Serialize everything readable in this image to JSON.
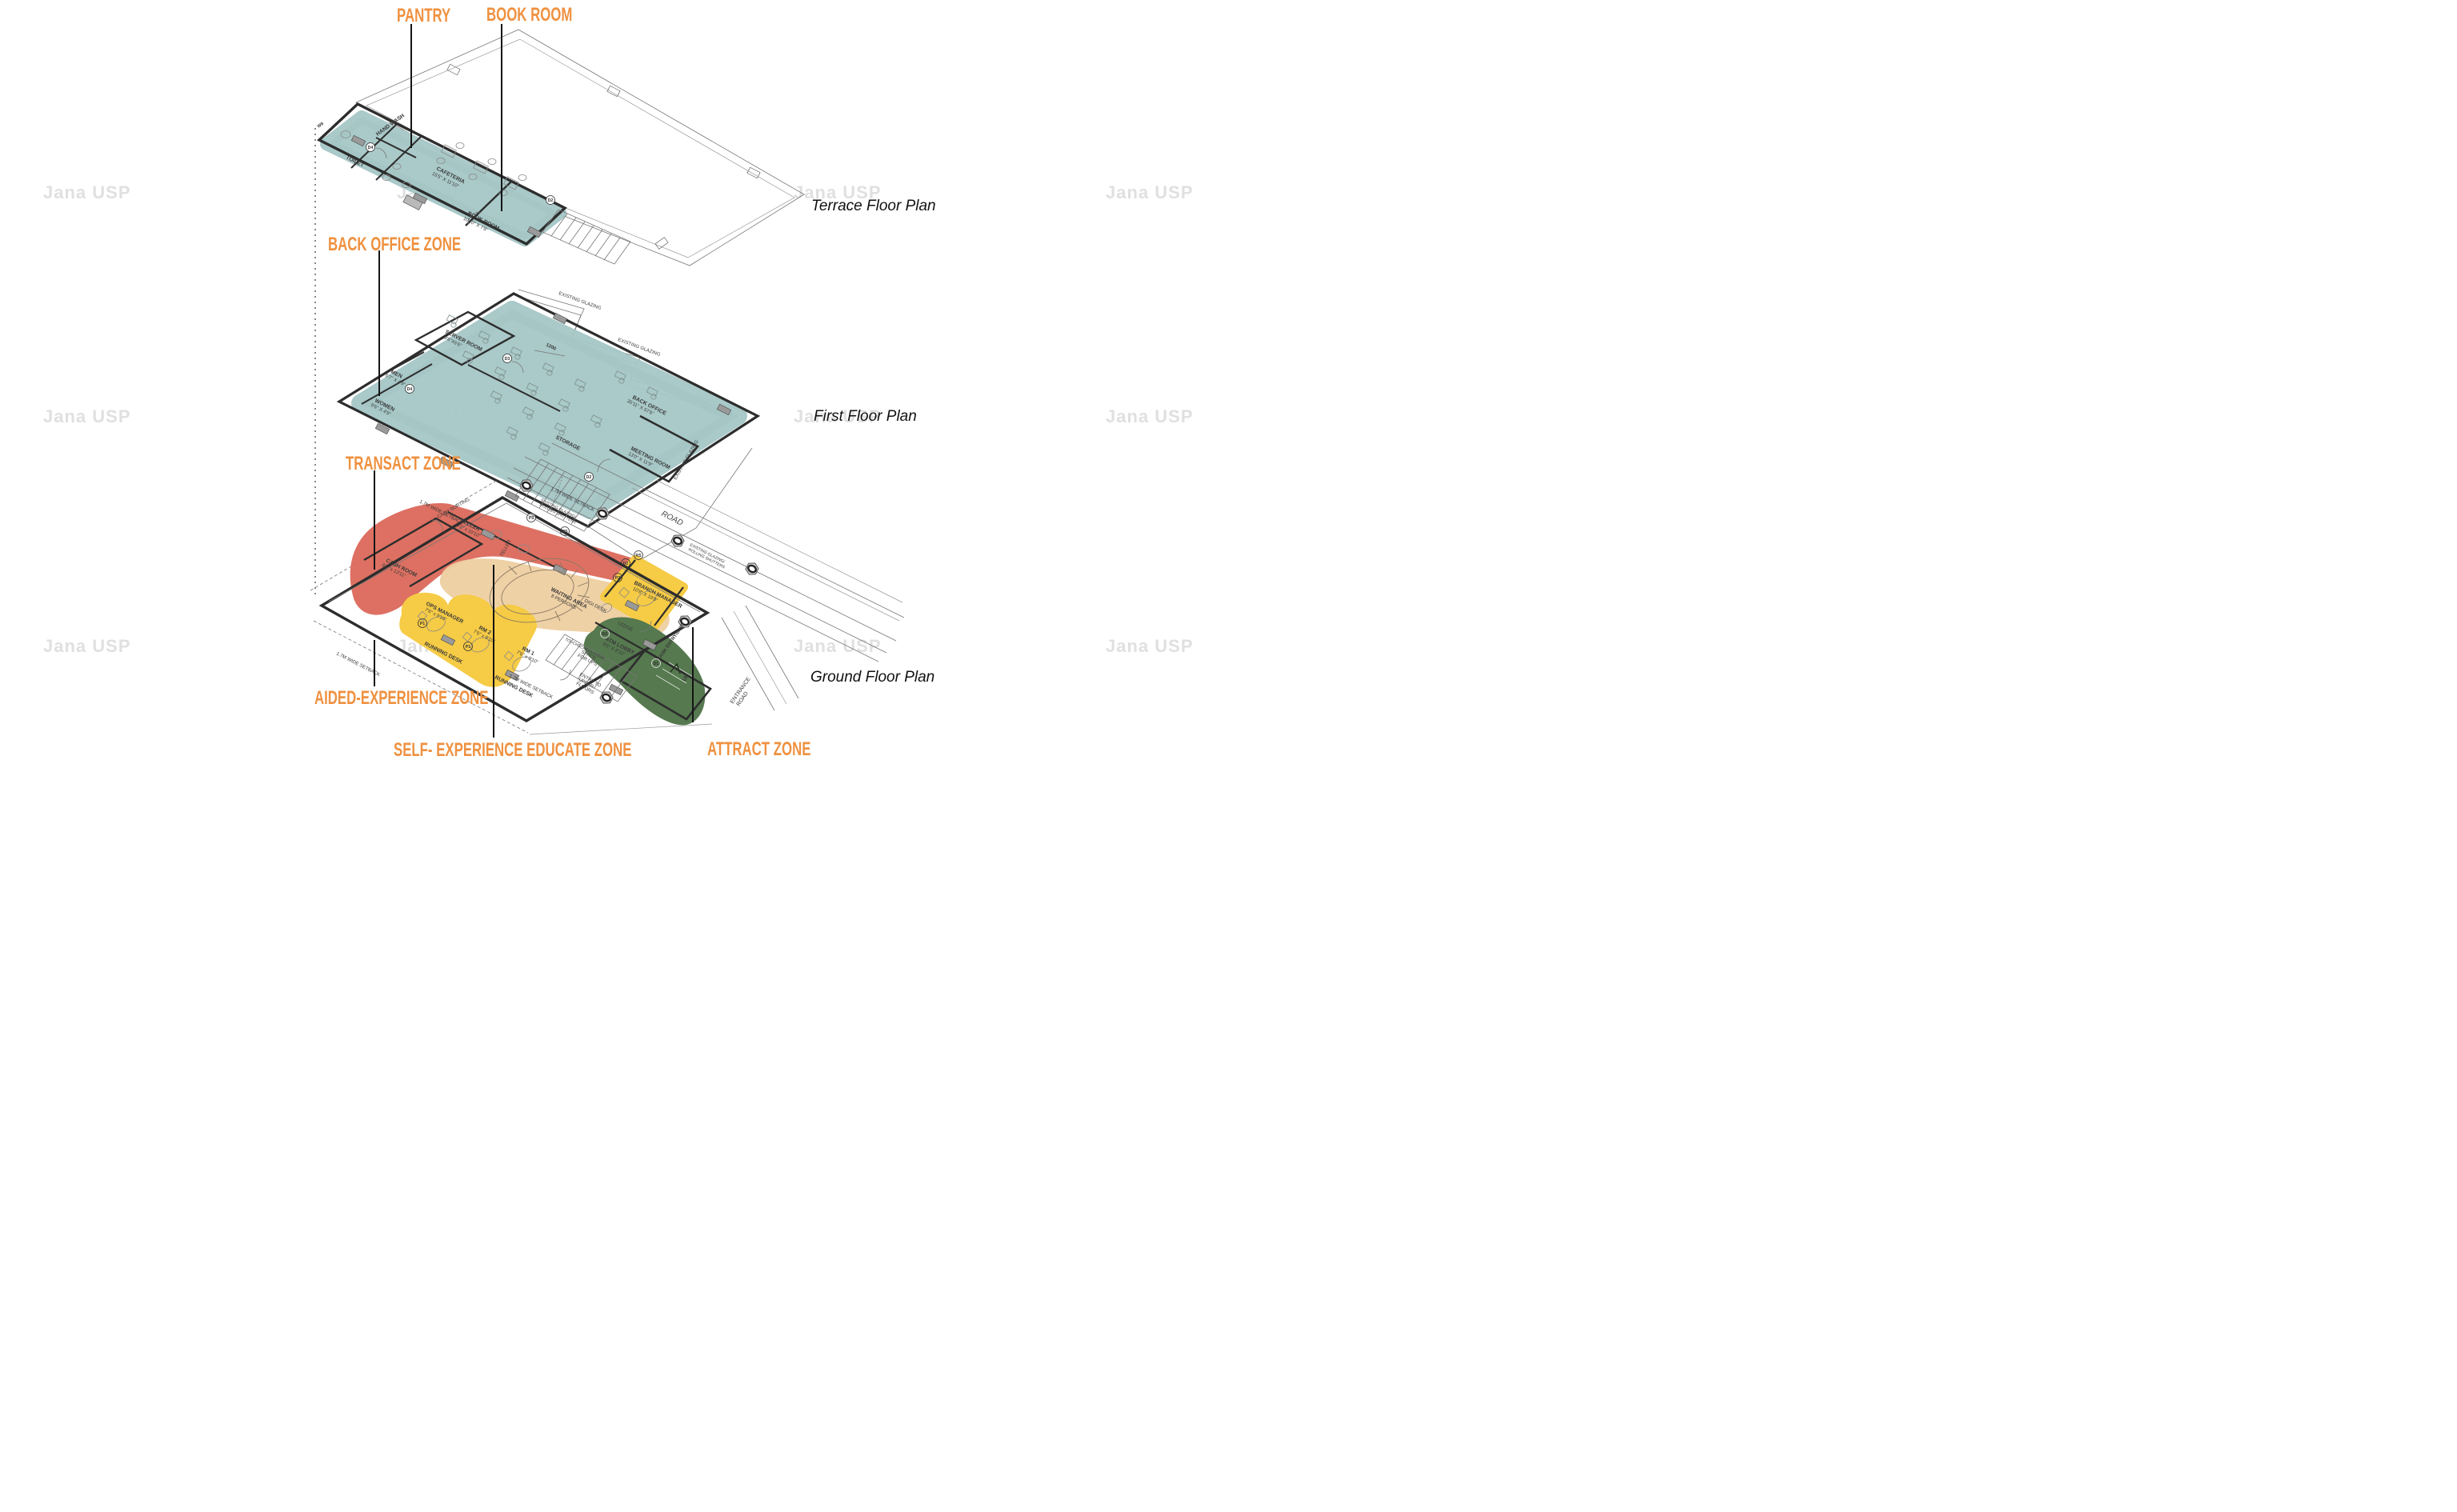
{
  "watermark": {
    "text": "Jana USP"
  },
  "zone_labels": {
    "pantry": "PANTRY",
    "book_room": "BOOK ROOM",
    "back_office": "BACK OFFICE ZONE",
    "transact": "TRANSACT ZONE",
    "aided": "AIDED-EXPERIENCE ZONE",
    "self_exp": "SELF- EXPERIENCE EDUCATE ZONE",
    "attract": "ATTRACT ZONE"
  },
  "floor_titles": {
    "terrace": "Terrace Floor Plan",
    "first": "First Floor Plan",
    "ground": "Ground Floor Plan"
  },
  "colors": {
    "teal": "#A5C6C6",
    "red": "#DB685A",
    "tan": "#EECFA1",
    "yellow": "#F6CB45",
    "green": "#56794F",
    "orange": "#EF9140"
  },
  "terrace": {
    "hand_wash": "HAND WASH",
    "toilet": "TOILET",
    "cafeteria": "CAFETERIA",
    "cafeteria_dim": "15'5\" X 11'10\"",
    "book_room": "BOOK ROOM",
    "book_room_dim": "10'10\" X 7'8\"",
    "w8": "W8",
    "d4": "D4",
    "d2": "D2"
  },
  "first": {
    "server": "SERVER ROOM",
    "server_dim": "9'6\"X6'6\"",
    "men": "MEN",
    "men_dim": "6'7\" X 4'9\"",
    "women": "WOMEN",
    "women_dim": "9'6\" X 4'9\"",
    "back_office": "BACK OFFICE",
    "back_office_dim": "35'11\" X 57'6\"",
    "meeting": "MEETING ROOM",
    "meeting_dim": "13'0\" X 11'9\"",
    "storage": "STORAGE",
    "glazing": "EXISTING GLAZING",
    "dim1200": "1200",
    "d2": "D2",
    "d3": "D3",
    "d4": "D4"
  },
  "ground": {
    "cash_sorting": "CASH SORTING",
    "teller": "TELLER",
    "teller_dim": "9'2\" x 10'10\"",
    "teller_desk": "TELLER",
    "cash_room": "CASH ROOM",
    "cash_room_dim": "8'5\" x 13'11\"",
    "waiting1": "WAITING AREA",
    "waiting2": "8 PERSONS",
    "ops": "OPS MANAGER",
    "ops_dim": "7'6\" x 9'10\"",
    "rm2": "RM 2",
    "rm1": "RM 1",
    "rm_dim": "7'6\" x 9'10\"",
    "running_desk": "RUNNING DESK",
    "digi": "DIGI DESK",
    "kiosk": "TOUCHSCREEN KIOSK",
    "bm": "BRANCH MANAGER",
    "bm_dim": "10'8\" X 10'0\"",
    "ledge": "LEDGE",
    "atm": "ATM LOBBY",
    "atm_dim": "9'5\" X 8'10\"",
    "bank_entry": "BANK ENTRY/EXIT",
    "up": "UP",
    "ups1": "SPACE",
    "ups2": "FOR UPS",
    "entry_upper_1": "ENTRY TO",
    "entry_upper_2": "UPPER",
    "entry_upper_3": "FLOORS",
    "road": "ROAD",
    "entrance_road_1": "ENTRANCE",
    "entrance_road_2": "ROAD",
    "setback": "1.7M WIDE SETBACK",
    "glazing_1": "EXISTING GLAZING/",
    "glazing_2": "ROLLING SHUTTERS",
    "d1": "D1",
    "d2": "D2",
    "p1": "P1",
    "p2": "P2",
    "p3": "P3",
    "rs": "RS"
  }
}
